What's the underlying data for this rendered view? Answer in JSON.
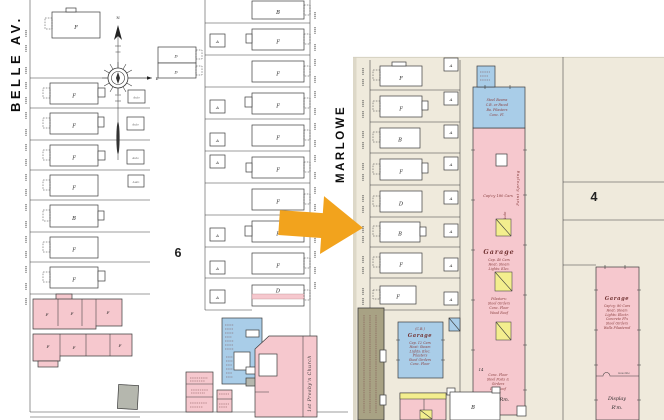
{
  "palette": {
    "paper_left": "#ffffff",
    "paper_right": "#efeadc",
    "building_pink": "#f6c8ce",
    "building_blue": "#a9cde8",
    "building_yellow": "#f3ee8e",
    "building_gray": "#b5b7ae",
    "building_olive": "#a8a284",
    "arrow_orange": "#f2a31d",
    "ink": "#3c3c3c",
    "note_red": "#8a4040"
  },
  "left_map": {
    "street_left": "BELLE AV.",
    "street_right": "MARLOWE",
    "block_number": "6",
    "compass": {
      "north": "N",
      "east": "E"
    },
    "col1_letters": [
      "F",
      "F",
      "F",
      "F",
      "F",
      "B",
      "F",
      "F"
    ],
    "col2_letters": [
      "B",
      "F",
      "F",
      "F",
      "F",
      "F",
      "F",
      "F",
      "F",
      "D"
    ],
    "rear_pair_letters": [
      "D",
      "D"
    ],
    "auto_sheds": [
      "Auto",
      "Auto",
      "Auto",
      "Auto"
    ],
    "garage_letters": [
      "A",
      "A",
      "A",
      "A",
      "A",
      "A",
      "A"
    ],
    "rowhouse_letters": [
      "F",
      "F",
      "F",
      "F",
      "F",
      "F"
    ],
    "church_label": "1st Presby'n Church"
  },
  "right_map": {
    "block_number": "4",
    "lot_letters": [
      "F",
      "F",
      "B",
      "F",
      "D",
      "B",
      "F",
      "F"
    ],
    "garage_letters": [
      "A",
      "A",
      "A",
      "A",
      "A",
      "A",
      "A",
      "A"
    ],
    "main_garage": {
      "construction_note": [
        "Steel Beams",
        "C.B. or Faced",
        "Ba. Pilasters",
        "Conc. Fl."
      ],
      "paint_spraying": "Paint Spraying",
      "capacity": "Cap'cy 180 Cars",
      "auto": "Auto",
      "title": "Garage",
      "note_upper": [
        "Cap. 40 Cars",
        "Heat: Steam",
        "Lights: Elec."
      ],
      "note_mid": [
        "Pilasters:",
        "Steel Girders",
        "Conc. Floor",
        "Wood Roof"
      ],
      "width_dim": "14",
      "note_lower": [
        "Conc. Floor",
        "Steel Posts &",
        "Girders",
        "Iron Roof"
      ],
      "show_room": "Show Rm."
    },
    "display_garage": {
      "title": "Garage",
      "notes": [
        "Cap'cy: 80 Cars",
        "Heat: Steam",
        "Lights: Electr.",
        "Concrete Fl's",
        "Steel Girders",
        "Walls Pilastered"
      ],
      "gasoline": "Gasoline",
      "display_room": [
        "Display",
        "R'm."
      ]
    },
    "cb_garage": {
      "code": "(C.B.)",
      "title": "Garage",
      "notes": [
        "Cap. 12 Cars",
        "Heat: Steam",
        "Lights: Elec.",
        "Pilasters",
        "Steel Girders",
        "Conc. Floor"
      ]
    },
    "b_building_letter": "B"
  }
}
